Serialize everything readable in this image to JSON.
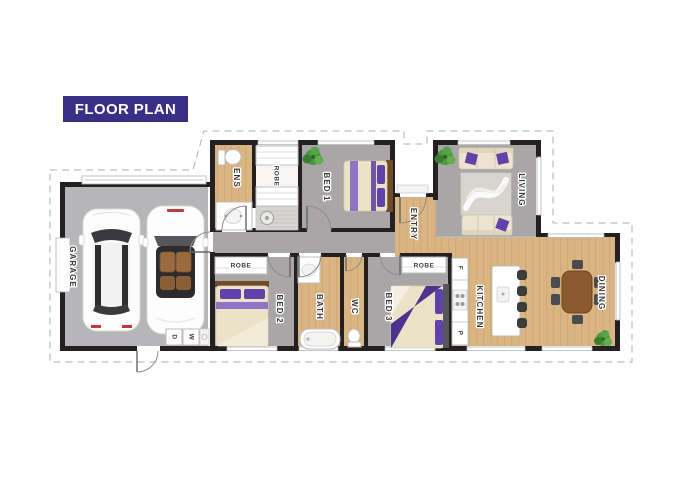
{
  "banner": {
    "label": "FLOOR PLAN"
  },
  "rooms": {
    "garage": "GARAGE",
    "ens": "ENS",
    "robe_walkin": "ROBE",
    "bed1": "BED 1",
    "entry": "ENTRY",
    "living": "LIVING",
    "robe_bed2": "ROBE",
    "bed2": "BED 2",
    "bath": "BATH",
    "wc": "WC",
    "robe_bed3": "ROBE",
    "bed3": "BED 3",
    "kitchen": "KITCHEN",
    "dining": "DINING"
  },
  "appliances": {
    "dryer": "D",
    "washer": "W",
    "fridge": "F",
    "pantry": "P"
  },
  "colors": {
    "banner_bg": "#3b2e87",
    "banner_text": "#ffffff",
    "wall": "#242021",
    "carpet": "#a9a6a7",
    "wood": "#d9b583",
    "wood_grain": "#c89e67",
    "garage_floor": "#b6b5b7",
    "boundary": "#b0aeae",
    "label": "#3d3b3b",
    "accent_purple": "#5f43a8"
  }
}
